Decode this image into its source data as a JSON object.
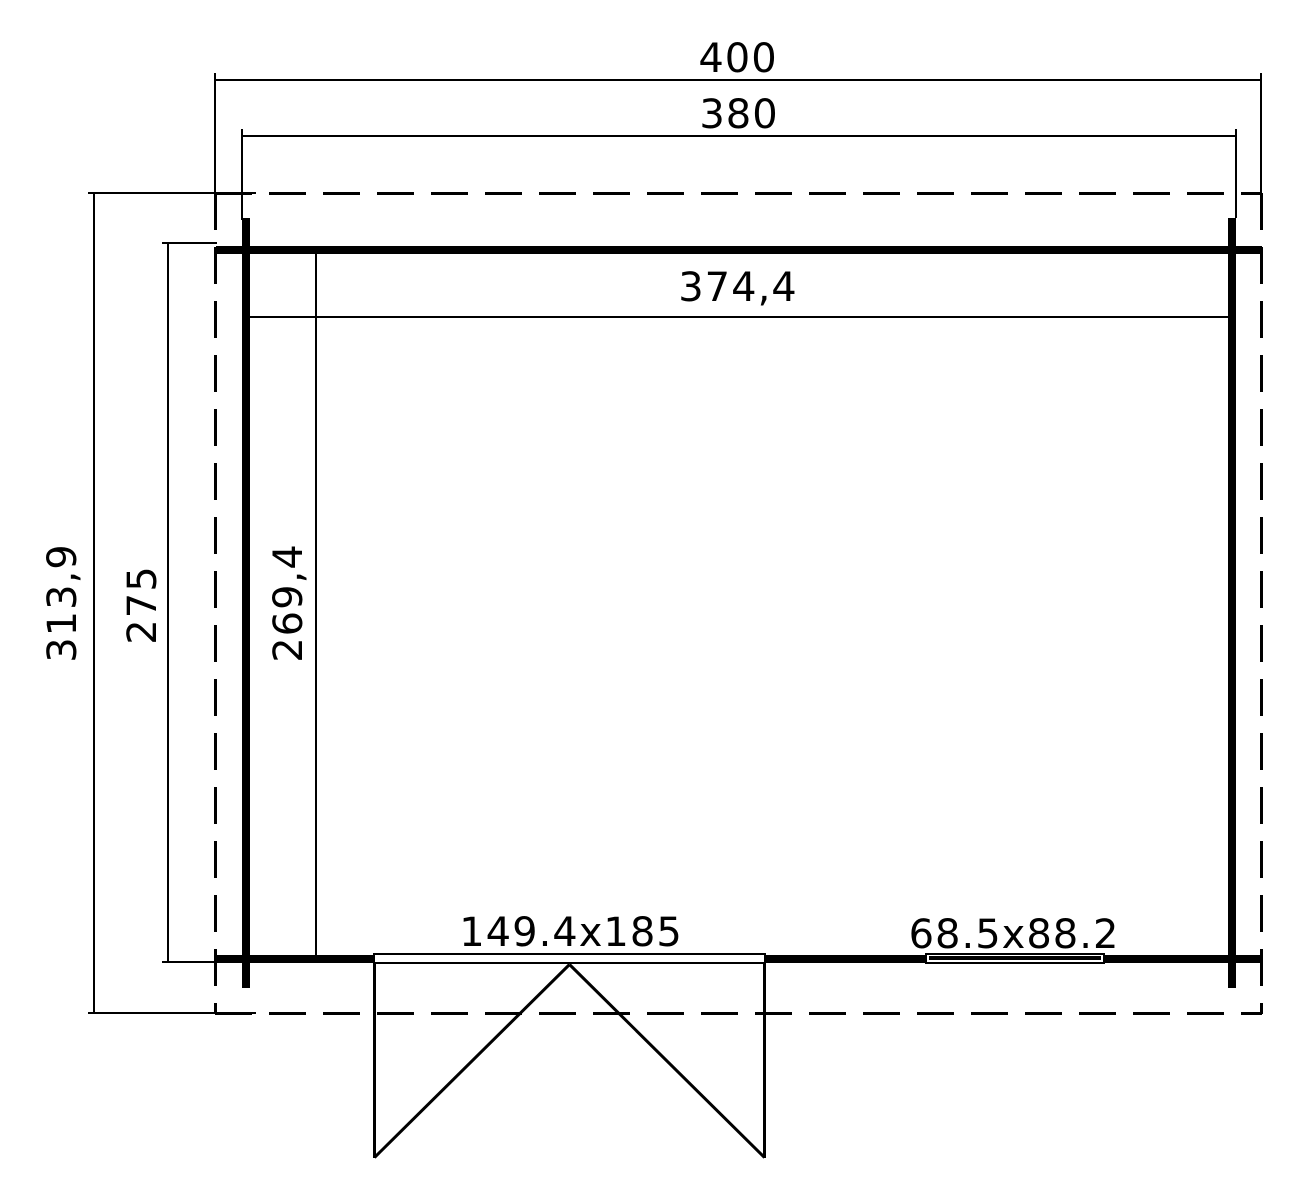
{
  "page": {
    "background": "#ffffff",
    "line_color": "#000000"
  },
  "plan": {
    "top_dimensions": {
      "roof_width": "400",
      "wall_width": "380",
      "interior_width": "374,4"
    },
    "left_dimensions": {
      "roof_depth": "313,9",
      "wall_depth": "275",
      "interior_depth": "269,4"
    },
    "openings": {
      "door_label": "149.4x185",
      "window_label": "68.5x88.2"
    }
  }
}
